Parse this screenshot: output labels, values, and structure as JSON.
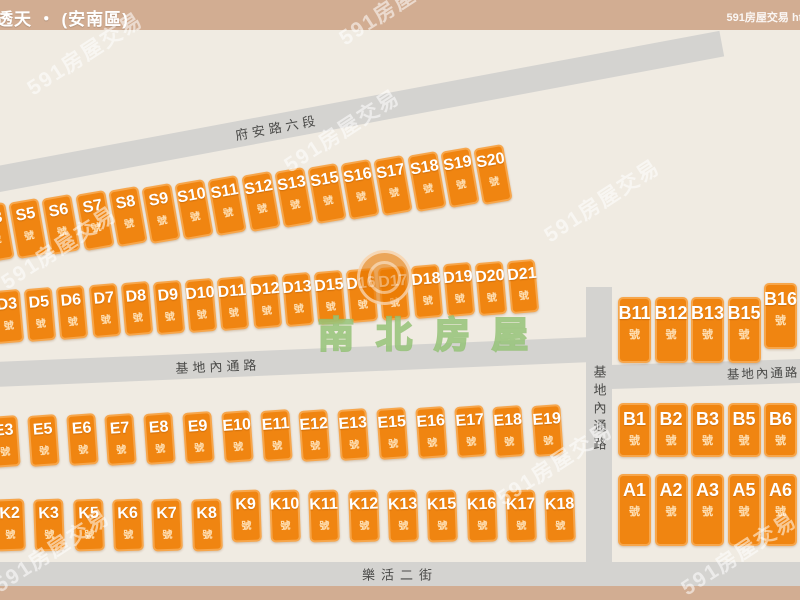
{
  "header": {
    "title": "透天 ・ (安南區)",
    "right_text": "591房屋交易 htt"
  },
  "streets": {
    "top": "府安路六段",
    "middle": "基地內通路",
    "right": "基地內通路",
    "vertical": "基地內通路",
    "bottom": "樂活二街"
  },
  "watermarks": {
    "brand": "南北房屋",
    "site": "591房屋交易"
  },
  "blocks": {
    "unit_suffix": "號",
    "rows": [
      {
        "name": "S",
        "labels": [
          "S3",
          "S5",
          "S6",
          "S7",
          "S8",
          "S9",
          "S10",
          "S11",
          "S12",
          "S13",
          "S15",
          "S16",
          "S17",
          "S18",
          "S19",
          "S20"
        ]
      },
      {
        "name": "D",
        "labels": [
          "D3",
          "D5",
          "D6",
          "D7",
          "D8",
          "D9",
          "D10",
          "D11",
          "D12",
          "D13",
          "D15",
          "D16",
          "D17",
          "D18",
          "D19",
          "D20",
          "D21"
        ]
      },
      {
        "name": "E",
        "labels": [
          "E3",
          "E5",
          "E6",
          "E7",
          "E8",
          "E9",
          "E10",
          "E11",
          "E12",
          "E13",
          "E15",
          "E16",
          "E17",
          "E18",
          "E19"
        ]
      },
      {
        "name": "K",
        "labels": [
          "K2",
          "K3",
          "K5",
          "K6",
          "K7",
          "K8",
          "K9",
          "K10",
          "K11",
          "K12",
          "K13",
          "K15",
          "K16",
          "K17",
          "K18"
        ]
      },
      {
        "name": "B-upper",
        "labels": [
          "B11",
          "B12",
          "B13",
          "B15",
          "B16"
        ]
      },
      {
        "name": "B-lower",
        "labels": [
          "B1",
          "B2",
          "B3",
          "B5",
          "B6"
        ]
      },
      {
        "name": "A",
        "labels": [
          "A1",
          "A2",
          "A3",
          "A5",
          "A6"
        ]
      }
    ]
  },
  "colors": {
    "background": "#f0ebe2",
    "bar": "#d2ad92",
    "road": "#d4d3d0",
    "block_fill": "#f08511",
    "block_border": "#f7a64b",
    "brand_green": "#8ebf6f"
  }
}
